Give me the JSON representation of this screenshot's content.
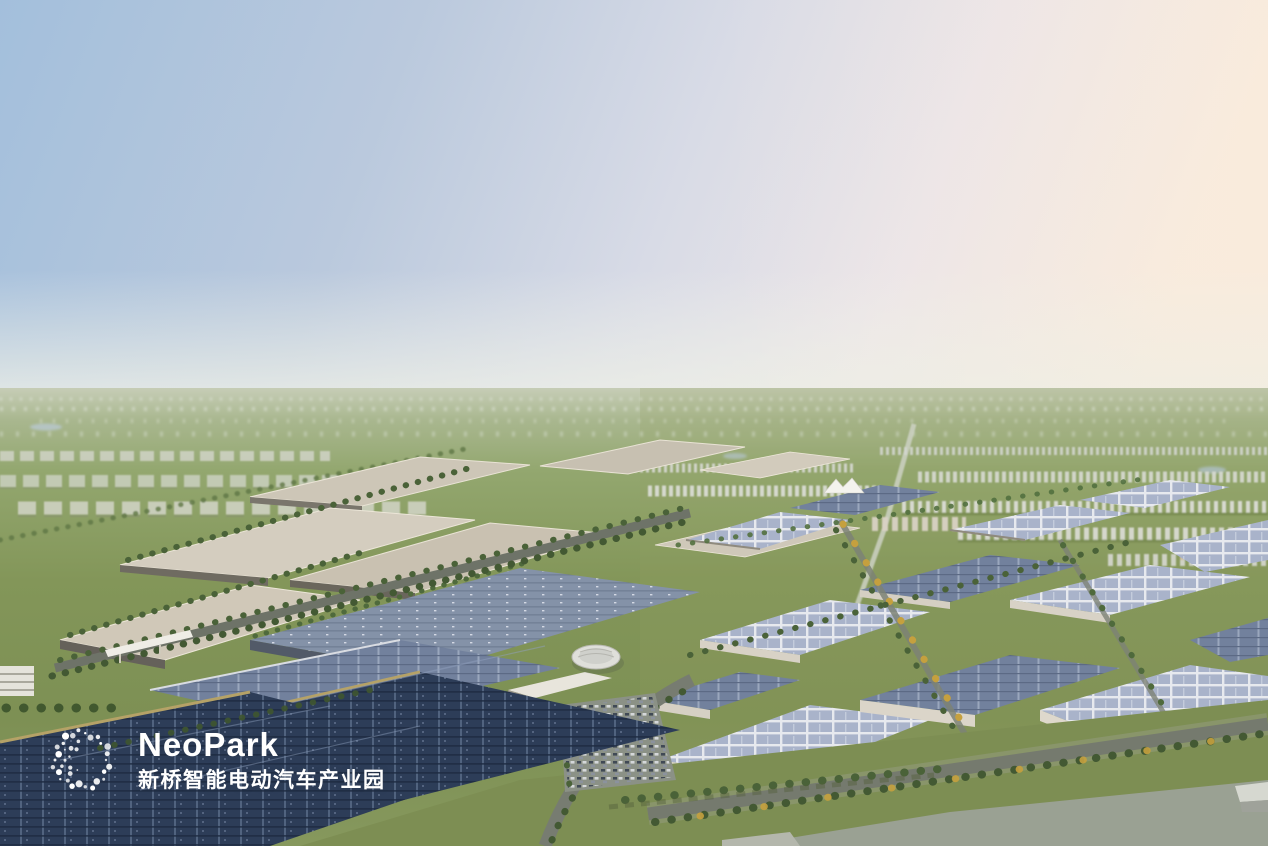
{
  "watermark": {
    "brand": "NeoPark",
    "subtitle_zh": "新桥智能电动汽车产业园",
    "logo_icon": "dot-ring-logo",
    "text_color": "#ffffff"
  },
  "scene": {
    "description_tags": [
      "aerial-rendering",
      "industrial-park",
      "solar-roofs",
      "green-fields"
    ],
    "palette": {
      "sky_left_blue": "#a3bfdc",
      "sky_right_pink": "#f8ecdf",
      "horizon_haze": "#d9dfd0",
      "far_fields_green": "#9caf74",
      "lawn_green": "#7d8e53",
      "road_grey": "#757a6e",
      "tree_green": "#4a6238",
      "tree_autumn_yellow": "#c5a03e",
      "factory_roof_beige": "#cdc6b7",
      "plant_roof_blue_grey": "#8492a8",
      "warehouse_panel_lavender": "#a9b3ca",
      "solar_roof_navy": "#2d3d58",
      "solar_trim_gold": "#b5a267",
      "city_towers_white": "#d6d8d2",
      "plaza_concrete": "#9aa193"
    }
  }
}
